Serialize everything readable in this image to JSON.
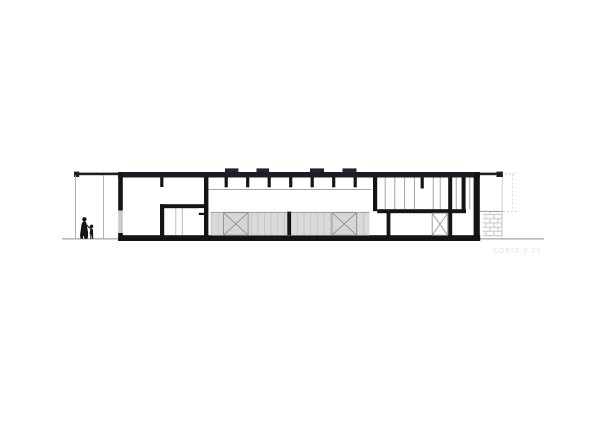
{
  "drawing": {
    "label": "CORTE 0.01",
    "colors": {
      "background": "#ffffff",
      "ink": "#141414",
      "roof": "#1d1d27",
      "panel_fill": "#dadada",
      "panel_stripe": "#c3c3c3",
      "detail_line": "#9a9a9a",
      "faint_line": "#c9c9c9",
      "wall_opening": "#c9c9c9",
      "ground": "#8f8f8f",
      "label_text": "#e3e3df"
    }
  }
}
